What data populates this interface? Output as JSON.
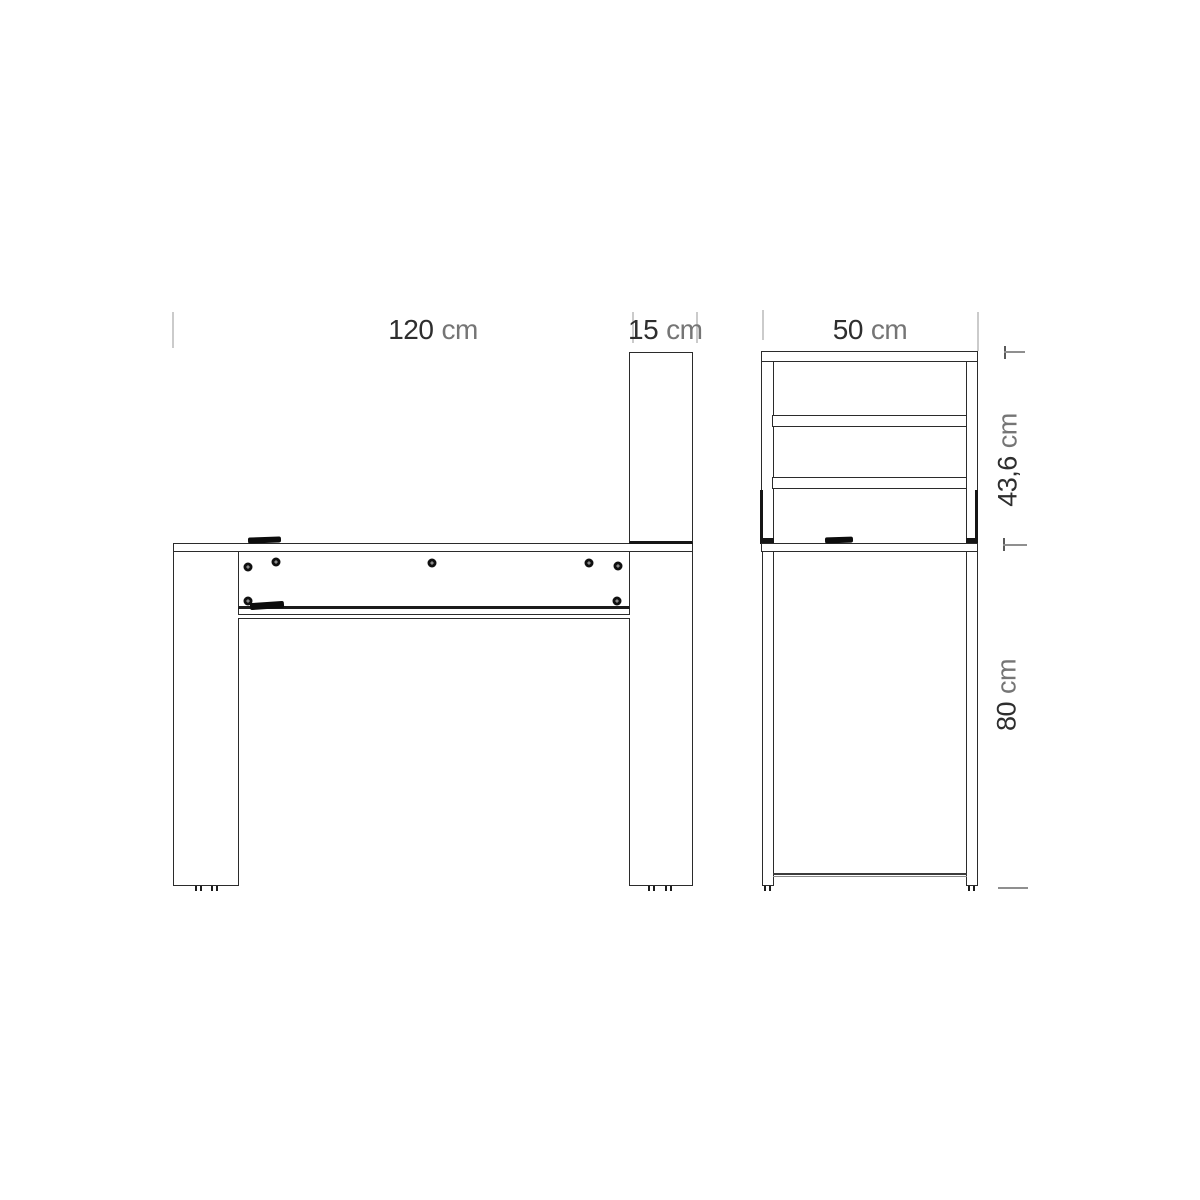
{
  "title": "Desk with hutch — dimension drawing (front and side elevations)",
  "labels": {
    "front_width": {
      "value": "120",
      "unit": "cm"
    },
    "front_column_width": {
      "value": "15",
      "unit": "cm"
    },
    "side_depth": {
      "value": "50",
      "unit": "cm"
    },
    "side_hutch_height": {
      "value": "43,6",
      "unit": "cm"
    },
    "side_total_height": {
      "value": "80",
      "unit": "cm"
    }
  },
  "dimensions": [
    {
      "target": "desk-width",
      "label": "120 cm",
      "orientation": "horizontal"
    },
    {
      "target": "side-column-width",
      "label": "15 cm",
      "orientation": "horizontal"
    },
    {
      "target": "desk-depth",
      "label": "50 cm",
      "orientation": "horizontal"
    },
    {
      "target": "hutch-height",
      "label": "43,6 cm",
      "orientation": "vertical"
    },
    {
      "target": "desk-height",
      "label": "80 cm",
      "orientation": "vertical"
    }
  ],
  "colors": {
    "background": "#ffffff",
    "line": "#2b2b2b",
    "heavy_line": "#151515",
    "dimension_value_text": "#2e2e2e",
    "dimension_unit_text": "#757575",
    "extension_tick": "#cbcbcb",
    "dimension_mark": "#8f8f8f",
    "hardware": "#0c0c0c"
  }
}
